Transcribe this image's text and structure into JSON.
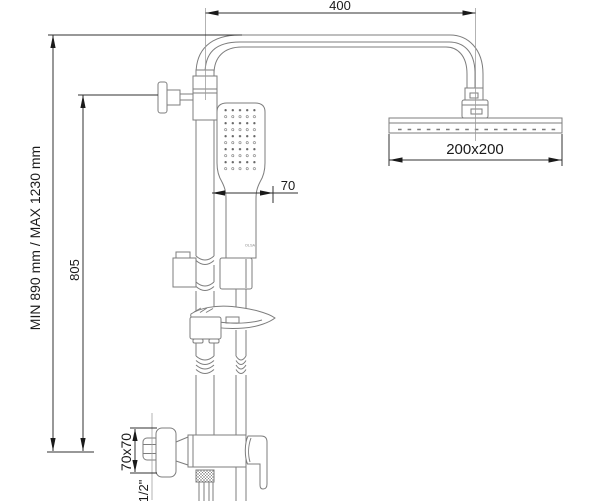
{
  "labels": {
    "top_width": "400",
    "head_size": "200x200",
    "hand_offset": "70",
    "height_range": "MIN 890 mm / MAX 1230 mm",
    "height_805": "805",
    "flange_size": "70x70",
    "thread": "1/2\"",
    "brand": "OLSA"
  },
  "colors": {
    "background": "#ffffff",
    "part_line": "#7d7d7d",
    "dimension_line": "#303030",
    "text": "#1a1a1a"
  }
}
